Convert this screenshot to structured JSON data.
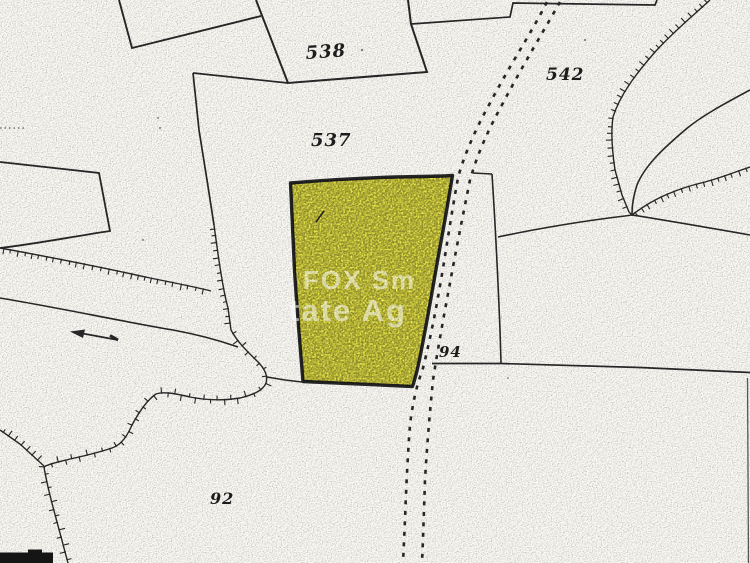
{
  "map": {
    "labels": {
      "p538": "538",
      "p537": "537",
      "p542": "542",
      "p94": "94",
      "p92": "92"
    },
    "watermark": {
      "line1": "FOX Sm",
      "line2": "tate Ag"
    },
    "icons": {
      "flow_arrow": "←"
    },
    "colors": {
      "highlight_parcel": "#f2ee4b",
      "map_lines": "#262626",
      "background": "#fbfaf5",
      "label_text": "#1c1c1c",
      "watermark": "#ffffff"
    }
  }
}
